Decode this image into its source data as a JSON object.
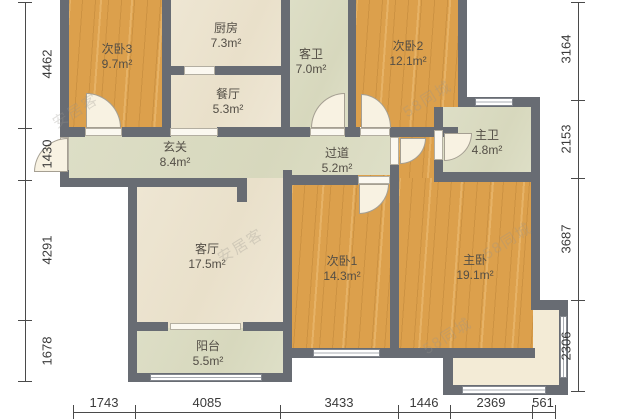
{
  "rooms": {
    "bedroom3": {
      "name": "次卧3",
      "area": "9.7m²"
    },
    "kitchen": {
      "name": "厨房",
      "area": "7.3m²"
    },
    "dining": {
      "name": "餐厅",
      "area": "5.3m²"
    },
    "guest_bath": {
      "name": "客卫",
      "area": "7.0m²"
    },
    "bedroom2": {
      "name": "次卧2",
      "area": "12.1m²"
    },
    "master_bath": {
      "name": "主卫",
      "area": "4.8m²"
    },
    "foyer": {
      "name": "玄关",
      "area": "8.4m²"
    },
    "corridor": {
      "name": "过道",
      "area": "5.2m²"
    },
    "living": {
      "name": "客厅",
      "area": "17.5m²"
    },
    "balcony": {
      "name": "阳台",
      "area": "5.5m²"
    },
    "bedroom1": {
      "name": "次卧1",
      "area": "14.3m²"
    },
    "master_bed": {
      "name": "主卧",
      "area": "19.1m²"
    }
  },
  "dimensions": {
    "left": [
      "4462",
      "1430",
      "4291",
      "1678"
    ],
    "right": [
      "3164",
      "2153",
      "3687",
      "2306"
    ],
    "bottom": [
      "1743",
      "4085",
      "3433",
      "1446",
      "2369",
      "561"
    ]
  },
  "watermarks": {
    "brand_58": "58同城",
    "brand_anjuke": "安居客"
  },
  "colors": {
    "wood_floor": "#dca04c",
    "cream_floor": "#ece3cf",
    "tile_floor": "#dbdcc2",
    "wall": "#686c73",
    "dimension_text": "#3a3a3a"
  }
}
